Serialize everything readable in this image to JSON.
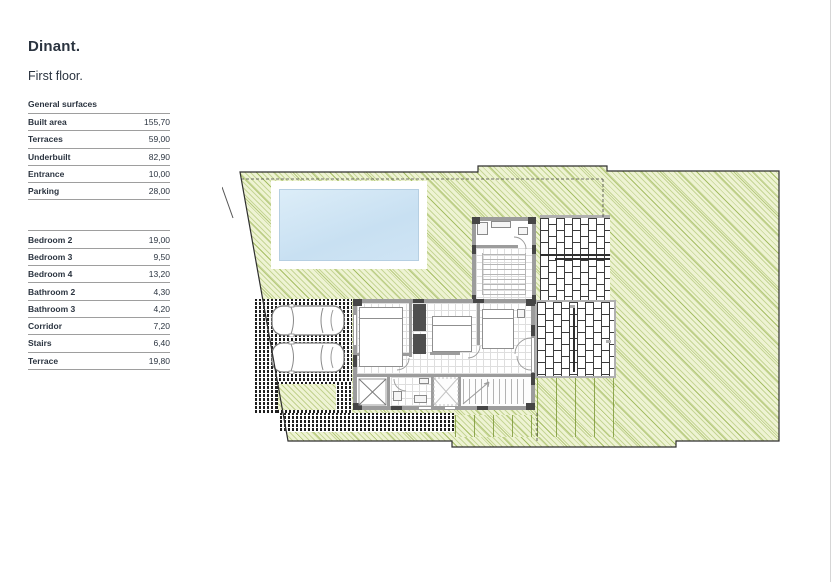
{
  "page": {
    "title": "Dinant.",
    "subtitle": "First floor."
  },
  "tables": {
    "general": {
      "heading": "General surfaces",
      "rows": [
        {
          "label": "Built area",
          "value": "155,70"
        },
        {
          "label": "Terraces",
          "value": "59,00"
        },
        {
          "label": "Underbuilt",
          "value": "82,90"
        },
        {
          "label": "Entrance",
          "value": "10,00"
        },
        {
          "label": "Parking",
          "value": "28,00"
        }
      ]
    },
    "rooms": {
      "rows": [
        {
          "label": "Bedroom 2",
          "value": "19,00"
        },
        {
          "label": "Bedroom 3",
          "value": "9,50"
        },
        {
          "label": "Bedroom 4",
          "value": "13,20"
        },
        {
          "label": "Bathroom 2",
          "value": "4,30"
        },
        {
          "label": "Bathroom 3",
          "value": "4,20"
        },
        {
          "label": "Corridor",
          "value": "7,20"
        },
        {
          "label": "Stairs",
          "value": "6,40"
        },
        {
          "label": "Terrace",
          "value": "19,80"
        }
      ]
    }
  },
  "plan": {
    "type": "architectural-floor-plan",
    "features": [
      "garden",
      "swimming-pool",
      "upper-terrace-brick",
      "lower-terrace-brick",
      "wood-deck",
      "parking-two-cars",
      "paved-walkway",
      "house-bedroom-wing",
      "house-bathroom-wing",
      "stairs",
      "plot-boundary"
    ],
    "colors": {
      "garden_green": "#eef3d3",
      "garden_hatch_line": "#8caa3c",
      "pool_water": "#cfe4f4",
      "wall_gray": "#9c9c9c",
      "wall_dark": "#464646",
      "brick_outline": "#3c3c3c",
      "paving_dark": "#1f1f1f",
      "terrace_frame": "#b0b0b0",
      "table_line": "#9e9e9e",
      "text": "#2b3440"
    }
  }
}
